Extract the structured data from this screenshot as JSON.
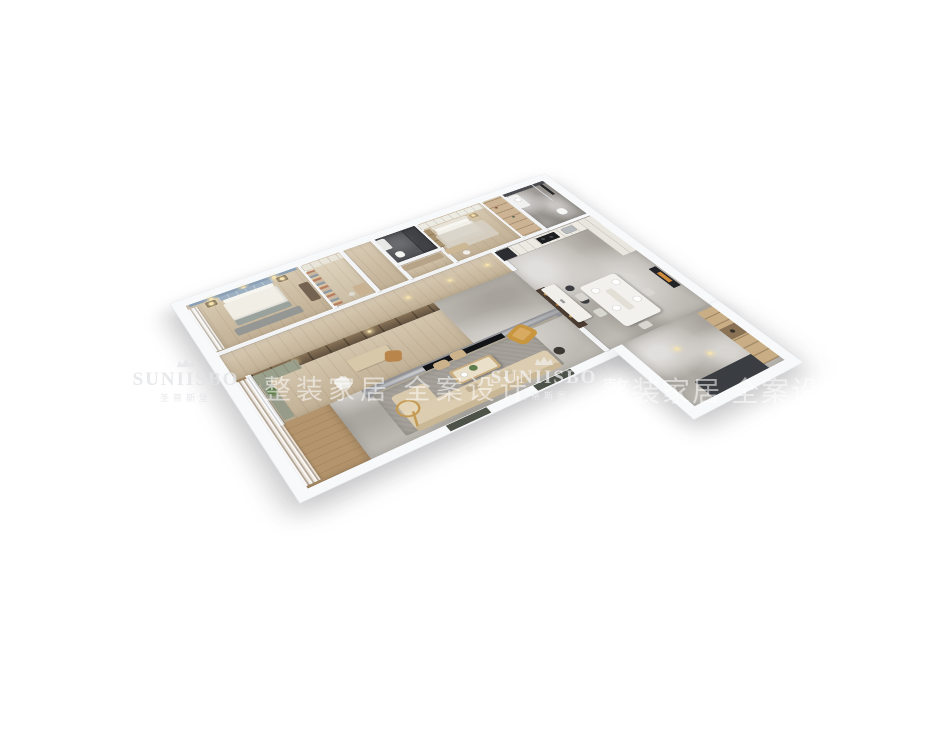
{
  "watermark": {
    "brand_en": "SUNIISBO",
    "brand_cn": "圣蒂斯堡",
    "slogan_cn": "整装家居 全案设计",
    "crown_icon": "crown-icon",
    "text_color": "rgba(255,255,255,0.6)"
  },
  "render": {
    "type": "isometric-3d-floorplan",
    "background": "#ffffff",
    "rooms": [
      "master-bedroom",
      "walk-in-closet",
      "hallway",
      "dark-bathroom",
      "second-bedroom",
      "pantry-closet",
      "main-bathroom",
      "corridor",
      "study",
      "kitchen",
      "dining-room",
      "living-room",
      "balcony",
      "entry-foyer"
    ],
    "palette": {
      "wall": "#f4f5f6",
      "wood_floor": "#cdbb9e",
      "balcony_wood": "#b3946c",
      "marble_floor": "#bdb9b3",
      "dark_bathroom": "#55565a",
      "tv_wall_marble": "#8f9196",
      "sofa_beige": "#d9c9ac",
      "leather_tan": "#c8963f",
      "headboard_blue": "#8ba0b5",
      "cabinet_oak": "#c8ad85",
      "sage_green": "#99a08c",
      "appliance_black": "#2b2d30",
      "art_orange": "#cf8a3a"
    }
  }
}
